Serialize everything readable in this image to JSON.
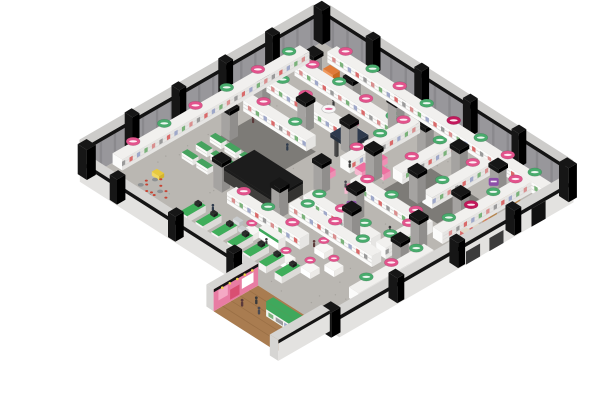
{
  "meta": {
    "scene": "isometric-3d-store-floorplan-render",
    "background": "#ffffff"
  },
  "iso": {
    "origin": [
      322,
      42
    ],
    "u_axis": [
      2.43,
      1.55
    ],
    "v_axis": [
      -2.34,
      1.35
    ],
    "wall_thickness": 3.5,
    "far_wall_height": 32,
    "near_wall_height": 22
  },
  "palette": {
    "floor": "#bab7b2",
    "floor_speckle": "#a7a49f",
    "dark_patch": "#7d7b77",
    "wall_far_face": "#98979b",
    "wall_far_streak": "#8a898d",
    "wall_top_surface": "#cdccca",
    "wall_black_band": "#141414",
    "wall_near_face": "#e3e2e0",
    "wall_near_top": "#d6d5d3",
    "post_black": "#161616",
    "shelf_top": "#f1f0ee",
    "shelf_face_v": "#fbfbfa",
    "shelf_face_u": "#e6e5e3",
    "shelf_stripe": "#dcdbd9",
    "product_dots": [
      "#d98f8f",
      "#7ab27a",
      "#9fa8c9",
      "#d96a6a",
      "#9a9a9a"
    ],
    "column_top": "#b3b1af",
    "column_face_v": "#a5a3a1",
    "column_face_u": "#908e8c",
    "block_top": "#575552",
    "block_face_v": "#403f3d",
    "block_face_u": "#343331",
    "block_cap": "#1c1c1c",
    "checkout_green": "#3fae5a",
    "checkout_face": "#f4f4f2",
    "checkout_screen": "#2b2b2b",
    "gondola_green": "#46a35f",
    "cafe_red": "#c64434",
    "cafe_table": "#8d9193",
    "canopy_navy": "#2e3a4d",
    "booth_pink_top": "#ef6fa0",
    "booth_pink_face": "#f7b8d0",
    "kiosk_orange": "#e07b39",
    "yellow_ride": "#e8c93e",
    "gate_tan": "#c9985f",
    "gate_tan_dark": "#b5854e",
    "wood_floor": "#a97c50",
    "wood_plank": "#9a6f45",
    "pink_wall": "#e87ca3",
    "pink_wall_light": "#f4a9c4",
    "pink_wall_red": "#d94f72",
    "green_display": "#3fa85c",
    "spotlight_yellow": "#f0d24a",
    "person_colors": [
      "#3a3a3a",
      "#4a4a52",
      "#5b3a3a",
      "#2f3b4c"
    ],
    "cart_gray": "#c9ccce",
    "door_dark": "#3c3c3c",
    "door_open": "#101010"
  },
  "signs_palette": {
    "pink": "#e2538c",
    "green": "#49ab6d",
    "crimson": "#c2185b",
    "white": "#f7f7f7",
    "purple": "#8d4fa8"
  },
  "floor": {
    "speckle_count": 130,
    "dark_patches": [
      [
        12,
        40,
        24,
        16
      ],
      [
        62,
        20,
        22,
        18
      ]
    ]
  },
  "shelf_runs": [
    {
      "u": 8,
      "v": 2,
      "du": 89,
      "dv": 4,
      "signs": [
        "pink",
        "green",
        "pink",
        "green",
        "crimson",
        "green",
        "pink",
        "green"
      ]
    },
    {
      "u": 6,
      "v": 14,
      "du": 44,
      "dv": 4,
      "signs": [
        "pink",
        "green",
        "pink",
        "green"
      ]
    },
    {
      "u": 6,
      "v": 26,
      "du": 38,
      "dv": 4,
      "signs": [
        "green",
        "pink",
        "white",
        "pink"
      ]
    },
    {
      "u": 8,
      "v": 38,
      "du": 26,
      "dv": 4,
      "signs": [
        "pink",
        "green"
      ]
    },
    {
      "u": 52,
      "v": 58,
      "du": 28,
      "dv": 4,
      "signs": [
        "green",
        "pink",
        "green"
      ]
    },
    {
      "u": 36,
      "v": 74,
      "du": 30,
      "dv": 4,
      "signs": [
        "pink",
        "green",
        "pink"
      ]
    },
    {
      "u": 52,
      "v": 64,
      "du": 34,
      "dv": 4,
      "signs": [
        "green",
        "pink",
        "green"
      ]
    },
    {
      "u": 56,
      "v": 42,
      "du": 30,
      "dv": 4,
      "signs": [
        "pink",
        "green",
        "pink"
      ]
    },
    {
      "u": 0.5,
      "v": 10,
      "du": 4,
      "dv": 80,
      "signs": [
        "green",
        "pink",
        "green",
        "pink",
        "green",
        "pink"
      ]
    },
    {
      "u": 46,
      "v": 10,
      "du": 4,
      "dv": 30,
      "signs": [
        "pink",
        "green",
        "pink"
      ]
    },
    {
      "u": 60,
      "v": 8,
      "du": 4,
      "dv": 24,
      "signs": [
        "green",
        "pink"
      ]
    },
    {
      "u": 74,
      "v": 8,
      "du": 4,
      "dv": 26,
      "signs": [
        "pink",
        "green"
      ]
    },
    {
      "u": 88,
      "v": 6,
      "du": 4,
      "dv": 38,
      "signs": [
        "pink",
        "green",
        "crimson",
        "green"
      ]
    },
    {
      "u": 92,
      "v": 52,
      "du": 4,
      "dv": 32,
      "signs": [
        "green",
        "pink",
        "green"
      ]
    },
    {
      "u": 82,
      "v": 46,
      "du": 4,
      "dv": 16,
      "signs": [
        "pink",
        "green"
      ]
    }
  ],
  "columns": [
    {
      "u": 10,
      "v": 14
    },
    {
      "u": 26,
      "v": 14
    },
    {
      "u": 42,
      "v": 12
    },
    {
      "u": 56,
      "v": 14
    },
    {
      "u": 70,
      "v": 14
    },
    {
      "u": 84,
      "v": 12,
      "sign": "purple"
    },
    {
      "u": 8,
      "v": 34
    },
    {
      "u": 24,
      "v": 32
    },
    {
      "u": 40,
      "v": 30
    },
    {
      "u": 54,
      "v": 34
    },
    {
      "u": 70,
      "v": 32
    },
    {
      "u": 86,
      "v": 30
    },
    {
      "u": 12,
      "v": 52
    },
    {
      "u": 48,
      "v": 50
    },
    {
      "u": 64,
      "v": 52,
      "sign": "purple"
    },
    {
      "u": 86,
      "v": 48
    },
    {
      "u": 28,
      "v": 72
    },
    {
      "u": 48,
      "v": 68
    },
    {
      "u": 70,
      "v": 60
    },
    {
      "u": 90,
      "v": 60
    }
  ],
  "checkout_lanes": {
    "start_u": 32,
    "v": 86,
    "count": 7,
    "gap": 6.5,
    "du": 3,
    "dv": 8,
    "h": 7
  },
  "green_gondolas": [
    [
      12,
      58
    ],
    [
      18,
      58
    ],
    [
      24,
      58
    ],
    [
      12,
      64
    ],
    [
      18,
      64
    ],
    [
      24,
      64
    ],
    [
      12,
      70
    ],
    [
      18,
      70
    ]
  ],
  "cafe_tables": [
    [
      16,
      88
    ],
    [
      21,
      91
    ],
    [
      15,
      93
    ],
    [
      20,
      95
    ]
  ],
  "promo_tables": [
    [
      70,
      72
    ],
    [
      78,
      76
    ],
    [
      66,
      84
    ],
    [
      74,
      82
    ],
    [
      50,
      82
    ]
  ],
  "service_counter": {
    "u": 54,
    "v": 80,
    "du": 8,
    "dv": 3,
    "h": 10
  },
  "stock_block": {
    "u": 28,
    "v": 58,
    "du": 20,
    "dv": 13,
    "h": 11
  },
  "booth": {
    "canopy": {
      "u": 40,
      "v": 30,
      "size": 8,
      "roof_h": 4,
      "post_h": 18
    },
    "counters": [
      [
        50,
        28,
        4,
        3
      ],
      [
        55,
        32,
        4,
        3
      ],
      [
        51,
        35,
        3,
        4
      ],
      [
        45,
        44,
        3,
        3
      ]
    ],
    "round_display": [
      57,
      47,
      3,
      7
    ]
  },
  "kiosk": {
    "u": 12,
    "v": 9,
    "du": 4,
    "dv": 3,
    "h": 8
  },
  "yellow_ride": {
    "u": 12,
    "v": 83,
    "du": 3,
    "dv": 2.2,
    "h": 4
  },
  "gate": {
    "towers": [
      [
        94,
        16
      ],
      [
        94,
        26
      ]
    ],
    "tower_size": 3,
    "tower_h": 22,
    "beam": {
      "u": 94,
      "v": 16,
      "du": 3,
      "dv": 13,
      "h": 3,
      "z": 19
    },
    "stacks": [
      [
        94,
        32
      ],
      [
        94,
        36
      ]
    ]
  },
  "doors_se": {
    "opening": [
      12,
      18
    ],
    "dark_doors": [
      [
        30,
        36
      ],
      [
        40,
        46
      ]
    ]
  },
  "carts": [
    [
      44,
      82
    ],
    [
      48,
      84
    ]
  ],
  "people": [
    [
      24,
      20
    ],
    [
      36,
      30
    ],
    [
      14,
      44
    ],
    [
      30,
      46
    ],
    [
      48,
      38
    ],
    [
      54,
      46
    ],
    [
      42,
      62
    ],
    [
      56,
      60
    ],
    [
      62,
      66
    ],
    [
      50,
      78
    ],
    [
      68,
      74
    ],
    [
      36,
      84
    ],
    [
      78,
      52
    ],
    [
      84,
      30
    ],
    [
      90,
      12
    ],
    [
      74,
      62
    ],
    [
      58,
      84
    ],
    [
      44,
      74
    ]
  ],
  "entrance": {
    "floor": {
      "u": 70,
      "v": 100,
      "du": 26,
      "dv": 19
    },
    "left_wall": {
      "u": 67,
      "v": 100,
      "du": 3,
      "dv": 19,
      "h": 22
    },
    "right_wall": {
      "u": 96,
      "v": 100,
      "du": 3.5,
      "dv": 22,
      "h": 21
    },
    "green_display": {
      "u": 82,
      "v": 106,
      "du": 12,
      "dv": 3,
      "h": 15
    },
    "people": [
      [
        76,
        107
      ],
      [
        80,
        110
      ],
      [
        74,
        111
      ]
    ],
    "spotlight_count": 5
  },
  "wall_posts": {
    "ne_u": [
      18,
      38,
      58,
      78
    ],
    "nw_v": [
      18,
      38,
      58,
      78
    ],
    "sw_u": [
      12,
      36,
      60
    ],
    "se_v": [
      22,
      46,
      72
    ]
  }
}
